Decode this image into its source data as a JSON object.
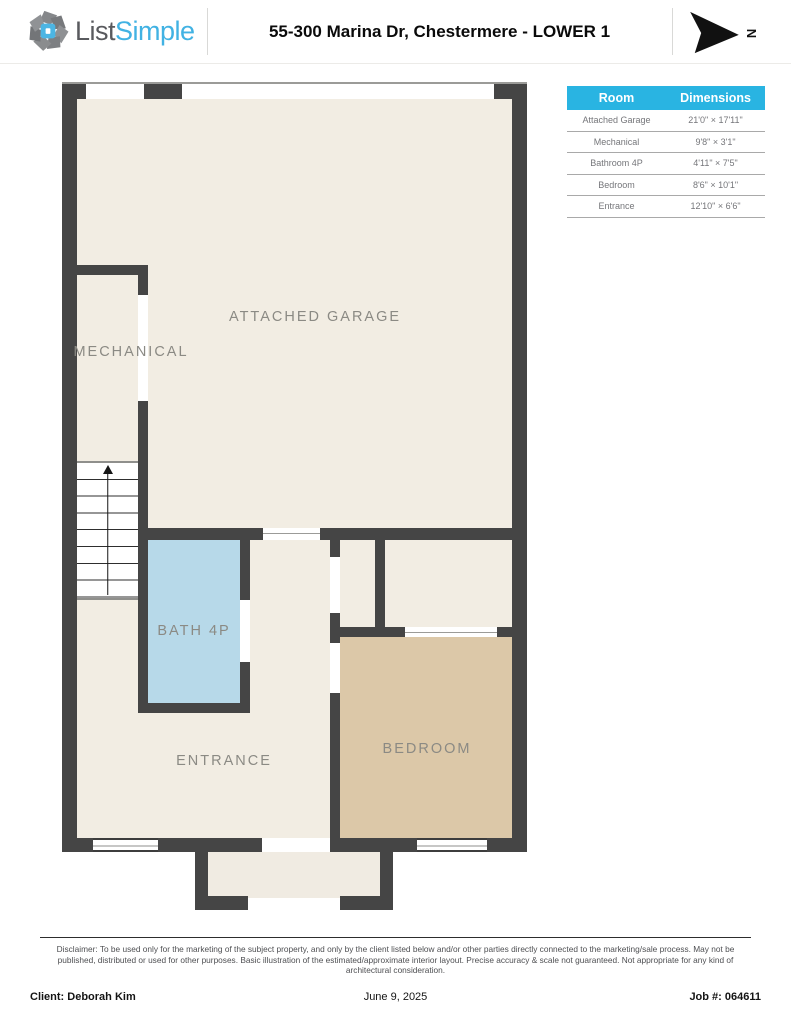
{
  "header": {
    "logo_text_dark": "List",
    "logo_text_blue": "Simple",
    "title": "55-300 Marina Dr, Chestermere - LOWER 1",
    "north_label": "N"
  },
  "dimensions_table": {
    "columns": [
      "Room",
      "Dimensions"
    ],
    "rows": [
      {
        "room": "Attached Garage",
        "dims": "21'0\" × 17'11\""
      },
      {
        "room": "Mechanical",
        "dims": "9'8\" × 3'1\""
      },
      {
        "room": "Bathroom 4P",
        "dims": "4'11\" × 7'5\""
      },
      {
        "room": "Bedroom",
        "dims": "8'6\" × 10'1\""
      },
      {
        "room": "Entrance",
        "dims": "12'10\" × 6'6\""
      }
    ]
  },
  "floor_plan": {
    "labels": {
      "garage": "ATTACHED GARAGE",
      "mechanical": "MECHANICAL",
      "bath": "BATH 4P",
      "entrance": "ENTRANCE",
      "bedroom": "BEDROOM"
    },
    "colors": {
      "wall": "#454545",
      "floor": "#f2ede3",
      "bath": "#b7d9e9",
      "bedroom": "#dcc8a8",
      "accent_blue": "#29b4e2"
    }
  },
  "disclaimer": "Disclaimer: To be used only for the marketing of the subject property, and only by the client listed below and/or other parties directly connected to the marketing/sale process. May not be published, distributed or used for other purposes. Basic illustration of the estimated/approximate interior layout. Precise accuracy & scale not guaranteed. Not appropriate for any kind of architectural consideration.",
  "footer": {
    "client": "Client: Deborah Kim",
    "date": "June 9, 2025",
    "job": "Job #: 064611"
  }
}
